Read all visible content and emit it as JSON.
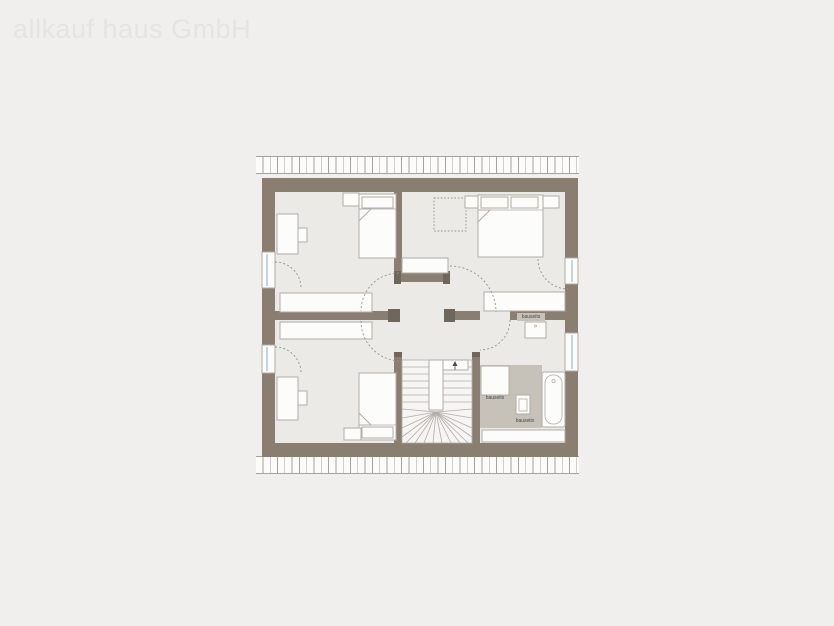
{
  "watermark": "allkauf haus GmbH",
  "plan": {
    "type": "floor-plan",
    "labels": {
      "wall_niche": "bauseits",
      "shower_area": "bauseits",
      "bath_floor": "bauseits"
    }
  },
  "colors": {
    "background": "#f0efed",
    "floor": "#ebeae7",
    "wall": "#8a7e71",
    "wall_cap": "#6f675c",
    "furniture_fill": "#fcfcfb",
    "furniture_stroke": "#b2ada6",
    "dash": "#97928b",
    "bauseits_area": "#c6c1b9",
    "glass": "#b9c9d6",
    "hatch_line": "#a6a19a",
    "watermark": "#e5e4e2",
    "label_text": "#4d4843"
  }
}
